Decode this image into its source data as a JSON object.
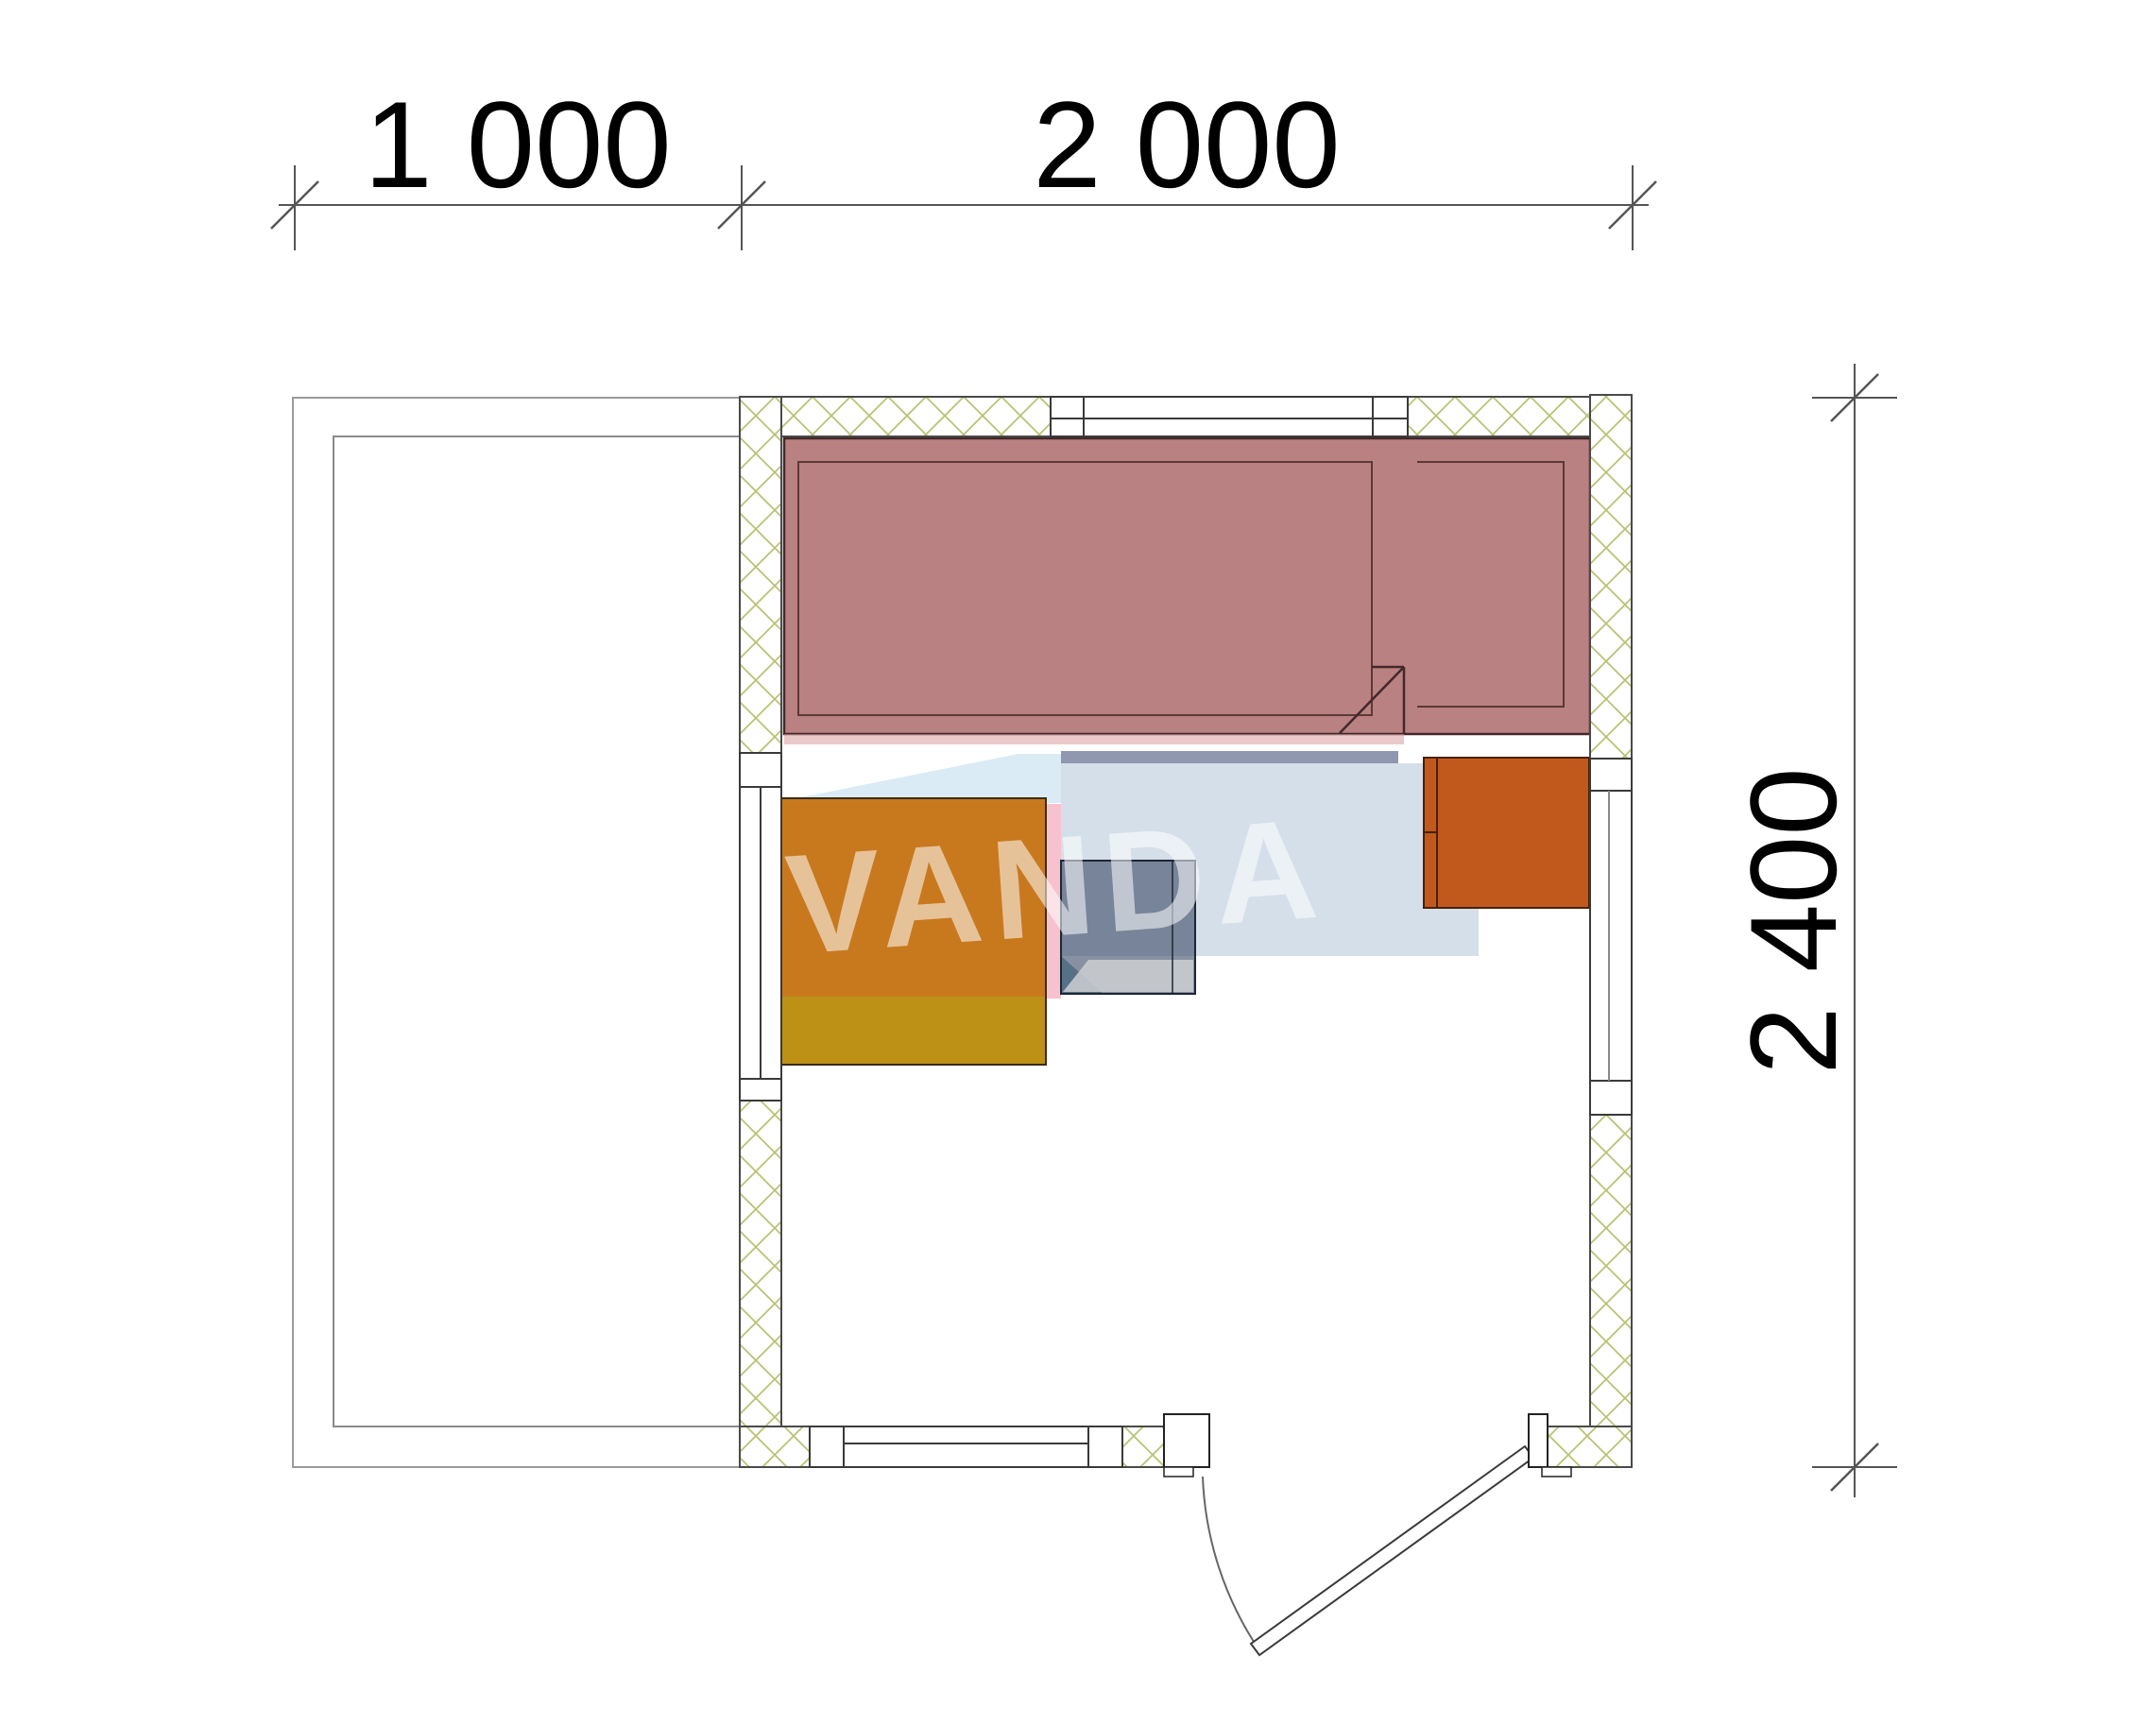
{
  "drawing": {
    "type": "floor-plan",
    "units": "mm",
    "watermark": {
      "text": "VANDA",
      "cube_color": "#d0dbe8",
      "top_face_color": "#cfe5f4",
      "rim_color": "#7b86a1",
      "accent_pink": "#f4aaba",
      "accent_teal": "#4e8f9e",
      "text_color": "#ffffff"
    },
    "dimensions": {
      "top": [
        {
          "label": "1 000",
          "value_mm": 1000
        },
        {
          "label": "2 000",
          "value_mm": 2000
        }
      ],
      "right": {
        "label": "2 400",
        "value_mm": 2400
      }
    },
    "elements": [
      {
        "name": "porch",
        "style": "thin gray double outline, open side toward cabin"
      },
      {
        "name": "exterior-walls",
        "style": "cross-hatched",
        "hatch_color": "#b9c173"
      },
      {
        "name": "sauna-bench",
        "color": "#b98181"
      },
      {
        "name": "table",
        "color_top": "#c8791e",
        "color_front": "#bd9115"
      },
      {
        "name": "stove",
        "color": "#5d6b80",
        "note": "semi-transparent gray-blue square"
      },
      {
        "name": "heater",
        "color": "#c2591c"
      },
      {
        "name": "windows",
        "count": 4,
        "positions": [
          "top wall",
          "left wall",
          "right wall",
          "bottom wall"
        ]
      },
      {
        "name": "entrance-door",
        "position": "bottom wall right",
        "swing": "outward"
      }
    ]
  }
}
